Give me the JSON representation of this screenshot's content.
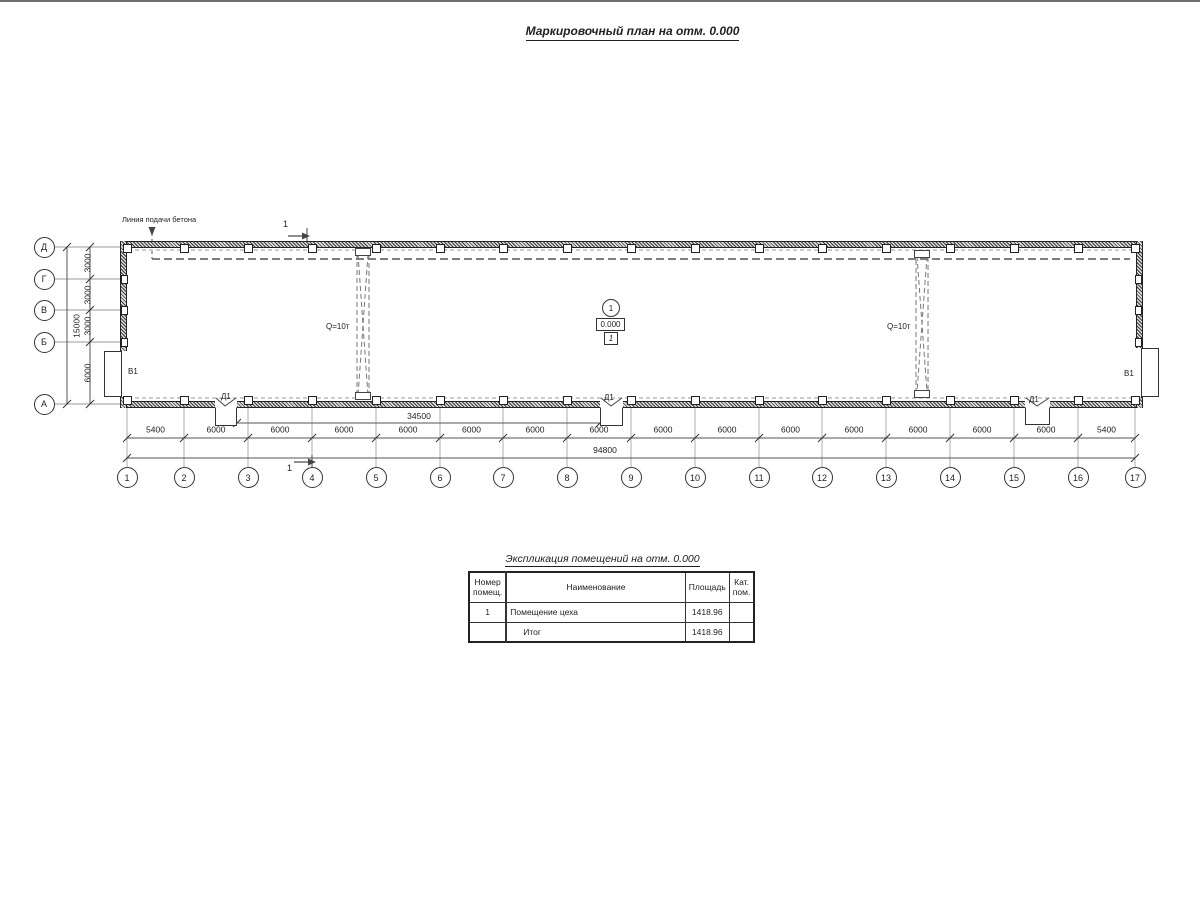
{
  "title": "Маркировочный план на отм. 0.000",
  "plan": {
    "concrete_line_label": "Линия подачи бетона",
    "crane_labels": [
      "Q=10т",
      "Q=10т"
    ],
    "gate_labels": [
      "В1",
      "В1"
    ],
    "door_labels": [
      "Д1",
      "Д1",
      "Д1"
    ],
    "section_marks": [
      "1",
      "1"
    ],
    "room_marker": {
      "number": "1",
      "elevation": "0.000",
      "category": "1"
    },
    "axes": {
      "letters": [
        "Д",
        "Г",
        "В",
        "Б",
        "А"
      ],
      "numbers": [
        "1",
        "2",
        "3",
        "4",
        "5",
        "6",
        "7",
        "8",
        "9",
        "10",
        "11",
        "12",
        "13",
        "14",
        "15",
        "16",
        "17"
      ]
    },
    "dimensions": {
      "left_segments": [
        "3000",
        "3000",
        "3000",
        "6000"
      ],
      "left_total": "15000",
      "bottom_door_span": "34500",
      "bottom_segments": [
        "5400",
        "6000",
        "6000",
        "6000",
        "6000",
        "6000",
        "6000",
        "6000",
        "6000",
        "6000",
        "6000",
        "6000",
        "6000",
        "6000",
        "6000",
        "5400"
      ],
      "bottom_total": "94800"
    }
  },
  "schedule": {
    "title": "Экспликация помещений на отм. 0.000",
    "headers": {
      "number": "Номер помещ.",
      "name": "Наименование",
      "area": "Площадь",
      "category": "Кат. пом."
    },
    "rows": [
      {
        "number": "1",
        "name": "Помещение цеха",
        "area": "1418.96",
        "category": ""
      },
      {
        "number": "",
        "name": "Итог",
        "area": "1418.96",
        "category": ""
      }
    ]
  }
}
